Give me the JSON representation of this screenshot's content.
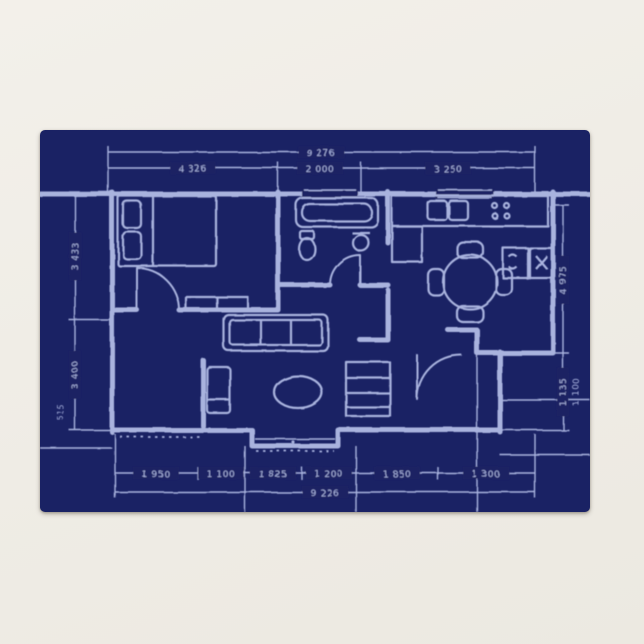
{
  "page": {
    "background": "#f1eee7"
  },
  "card": {
    "background": "#1a2264",
    "line_color": "#a9b3de"
  },
  "blueprint": {
    "dims_top": {
      "total": "9 276",
      "seg1": "4 326",
      "seg2": "2 000",
      "seg3": "3 250"
    },
    "dims_bottom": {
      "total": "9 226",
      "seg1": "1 950",
      "seg2": "1 100",
      "seg3": "1 825",
      "seg4": "1 200",
      "seg5": "1 850",
      "seg6": "1 300"
    },
    "dims_left": {
      "seg1": "3 433",
      "seg2": "3 400",
      "small": "515"
    },
    "dims_right": {
      "seg1": "4 975",
      "seg2": "1 135",
      "seg3": "1 100"
    }
  }
}
